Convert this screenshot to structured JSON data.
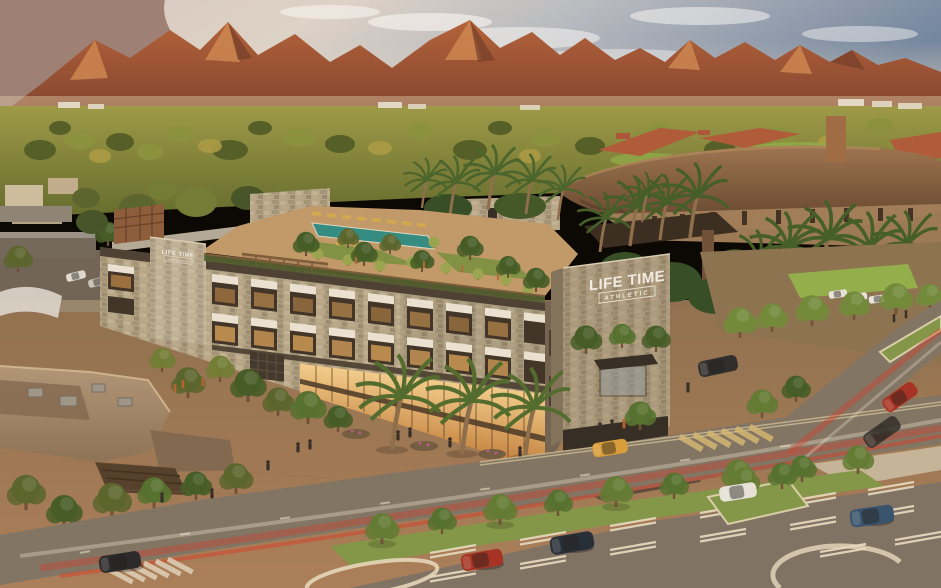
{
  "scene": {
    "signs": {
      "tower": {
        "line1": "LIFE TIME",
        "line2": "ATHLETIC"
      },
      "wing": {
        "line1": "LIFE TIME",
        "line2": "ATHLETIC"
      }
    },
    "palette": {
      "sky1": "#6f86a3",
      "sky2": "#c9c6c2",
      "sky3": "#e6d2ba",
      "mtnDark": "#6e3a28",
      "mtnMid": "#a85838",
      "mtnLight": "#cf8a52",
      "mtnHaze": "#9b7f78",
      "valGreen": "#7c8038",
      "valDark": "#4e5c26",
      "valLight": "#a3a84a",
      "hazeBand": "#dcc9a8",
      "stone": "#b3a68a",
      "stoneLight": "#cfc3a8",
      "stoneDark": "#8a7d66",
      "cornice": "#473e33",
      "glassHi": "#f3cf8e",
      "glassLo": "#c07c3a",
      "winDark": "#3a3127",
      "awning": "#eae5d8",
      "pool": "#2e8c85",
      "deck": "#c09a6c",
      "lawn": "#7d9143",
      "umbrella": "#97a54e",
      "lounger": "#d3aa4e",
      "wood": "#7a5a3a",
      "bronze": "#8a6547",
      "bronzeDark": "#5a3f2c",
      "tile": "#ad5838",
      "stucco": "#c9a176",
      "road": "#7d7365",
      "lot": "#7b7165",
      "stripe": "#e9dfc6",
      "terra": "#a87e5a",
      "grass": "#7f9748",
      "tree": "#5d7a33",
      "treeDark": "#3f5a26",
      "palm": "#4c6b2e",
      "trunk": "#8a6d4c",
      "streakRed": "#d63a28",
      "streakWhite": "#f2e9d8",
      "sign": "#f2efe8",
      "carRed": "#a32e22",
      "carNavy": "#1f2a38",
      "carBlue": "#31506e",
      "carDark": "#23242a",
      "taxi": "#d89e3a",
      "carWhite": "#e6e4df",
      "shadow": "#3a3226"
    }
  }
}
